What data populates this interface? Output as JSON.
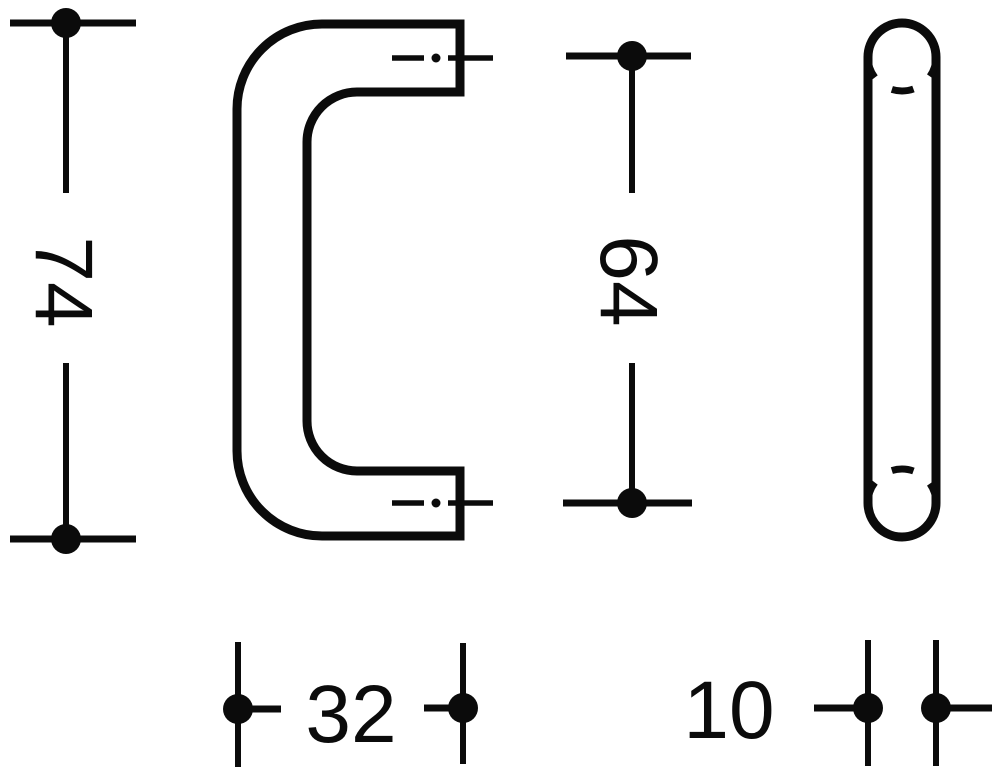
{
  "drawing": {
    "title": "pull-handle-dimension-drawing",
    "colors": {
      "line": "#0b0b0b",
      "background": "#ffffff"
    },
    "dimensions": {
      "height": "74",
      "hole_spacing": "64",
      "projection": "32",
      "diameter": "10"
    }
  }
}
